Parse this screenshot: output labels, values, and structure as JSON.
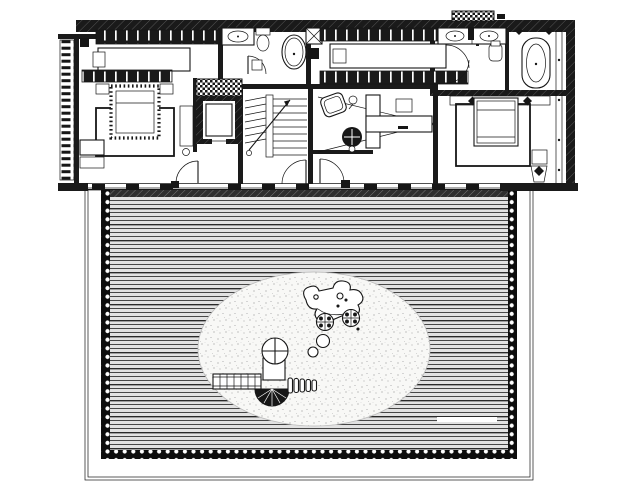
{
  "document": {
    "type": "architectural-floor-plan",
    "view": "top-down-plan-with-roof-deck",
    "visible_text": ""
  },
  "palette": {
    "paper": "#ffffff",
    "ink": "#161616",
    "wall": "#1a1a1a",
    "deck_field": "#e2e2e2",
    "deck_line": "#1f1f1f",
    "bead_band": "#0d0d0d",
    "sand": "#f8f8f6",
    "sand_dot": "#9a9a9a",
    "muted": "#bdbdbd",
    "threshold": "#2e2e2e"
  },
  "inventory": {
    "rooms": [
      "bedroom-left",
      "elevator-shaft",
      "bathroom-small",
      "stair-hall",
      "walk-in-closet",
      "study-room",
      "master-bathroom",
      "master-bedroom",
      "roof-deck",
      "sand-play-area"
    ],
    "fixtures": [
      "wardrobe-strip",
      "bed-double",
      "rug",
      "bench-seat",
      "dresser",
      "elevator-car",
      "u-stair",
      "wash-basin",
      "toilet",
      "oval-bathtub",
      "double-vanity",
      "freestanding-tub",
      "shower-heads",
      "desk-l-shaped",
      "office-chair",
      "armchair",
      "floor-lamp",
      "side-chair",
      "headboard-lamps",
      "lounge-chair",
      "roof-vent"
    ],
    "outdoor": [
      "timber-decking",
      "bead-border",
      "dotted-margin",
      "deck-bench",
      "play-tower-with-spiral-slide",
      "play-bridge",
      "climbing-sculpture",
      "stepping-balls"
    ]
  }
}
